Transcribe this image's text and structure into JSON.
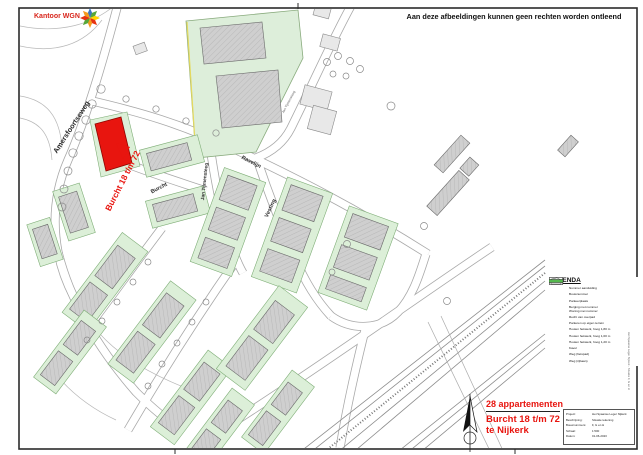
{
  "frame": {
    "disclaimer": "Aan deze afbeeldingen kunnen geen rechten worden ontleend",
    "side_caption": "Het Spaanse Leger Nijkerk - Situatie F, G en H"
  },
  "logo": {
    "label": "Kantoor WGN"
  },
  "map": {
    "highlight": {
      "label": "Burcht 18 t/m 72"
    },
    "streets": {
      "amersfoortseweg": "Amersfoortseweg",
      "burcht": "Burcht",
      "jan_tijmensteeg": "Jan Tijmensteeg",
      "jan_tijmensteeg_klein": "Jan Tijmensteeg",
      "ravelijn": "Ravelijn",
      "vesting": "Vesting"
    }
  },
  "legend": {
    "title": "LEGENDA",
    "items": [
      {
        "symbol": "triangle",
        "label": "Nummer aanduiding"
      },
      {
        "symbol": "code",
        "label": "Bouwnummer"
      },
      {
        "symbol": "yellow",
        "label": "Parkeerplaats"
      },
      {
        "symbol": "numbers",
        "label": "Berging met nummer",
        "label2": "Woning met nummer"
      },
      {
        "symbol": "gray",
        "label": "Recht van overpad"
      },
      {
        "symbol": "parking",
        "label": "Parkeren op eigen terrein"
      },
      {
        "symbol": "fence1",
        "label": "Houten hekwerk, hoog 1,80 m"
      },
      {
        "symbol": "fence2",
        "label": "Houten hekwerk, hoog 1,00 m"
      },
      {
        "symbol": "fence3",
        "label": "Houten hekwerk, hoog 1,20 m"
      },
      {
        "symbol": "kavel",
        "label": "Kavel"
      },
      {
        "symbol": "cyan",
        "label": "Weg (fietspad)"
      },
      {
        "symbol": "green",
        "label": "Weg (rijbaan)"
      }
    ]
  },
  "annotation": {
    "line1": "28 appartementen",
    "line2": "Burcht 18 t/m 72",
    "line3": "te Nijkerk"
  },
  "titleblock": {
    "rows": [
      {
        "label": "Project:",
        "value": "Het Spaanse Leger Nijkerk"
      },
      {
        "label": "Beschrijving:",
        "value": "Situatie tekening"
      },
      {
        "label": "Bouwnummers:",
        "value": "F, G en H"
      },
      {
        "label": "Schaal:",
        "value": "1:500"
      },
      {
        "label": "Datum:",
        "value": "01-06-2023"
      }
    ]
  },
  "colors": {
    "accent_red": "#e8150f",
    "parcel_green": "#dcefd8",
    "legend_cyan": "#9fd8e8",
    "legend_green": "#55b84e"
  }
}
